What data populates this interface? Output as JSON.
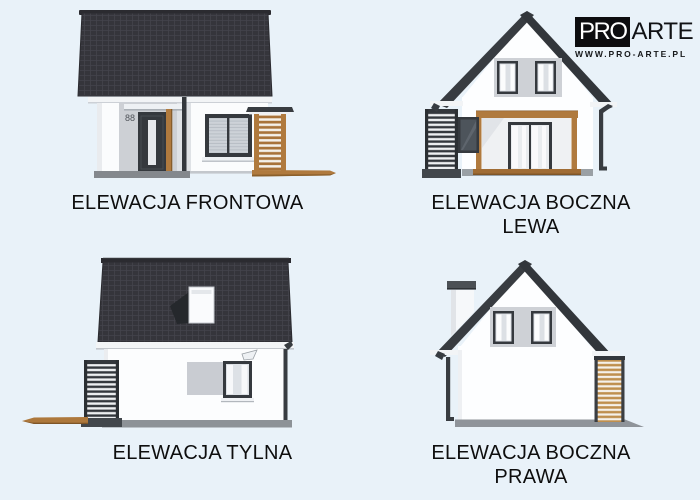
{
  "page": {
    "background_color": "#e9f2f9"
  },
  "logo": {
    "pro": "PRO",
    "arte": "ARTE",
    "url": "WWW.PRO-ARTE.PL"
  },
  "elevations": {
    "frontowa": {
      "label": "ELEWACJA FRONTOWA",
      "house_number": "88"
    },
    "boczna_lewa": {
      "label_line1": "ELEWACJA BOCZNA",
      "label_line2": "LEWA"
    },
    "tylna": {
      "label": "ELEWACJA TYLNA"
    },
    "boczna_prawa": {
      "label_line1": "ELEWACJA BOCZNA",
      "label_line2": "PRAWA"
    }
  },
  "colors": {
    "background": "#e9f2f9",
    "roof_tiles": "#35353b",
    "wall": "#fcfdfe",
    "accent_wood": "#b07a3e",
    "window_frame": "#35393e",
    "gray_panel": "#ced1d6",
    "plinth": "#8f949a",
    "label_text": "#0e0e0e"
  }
}
